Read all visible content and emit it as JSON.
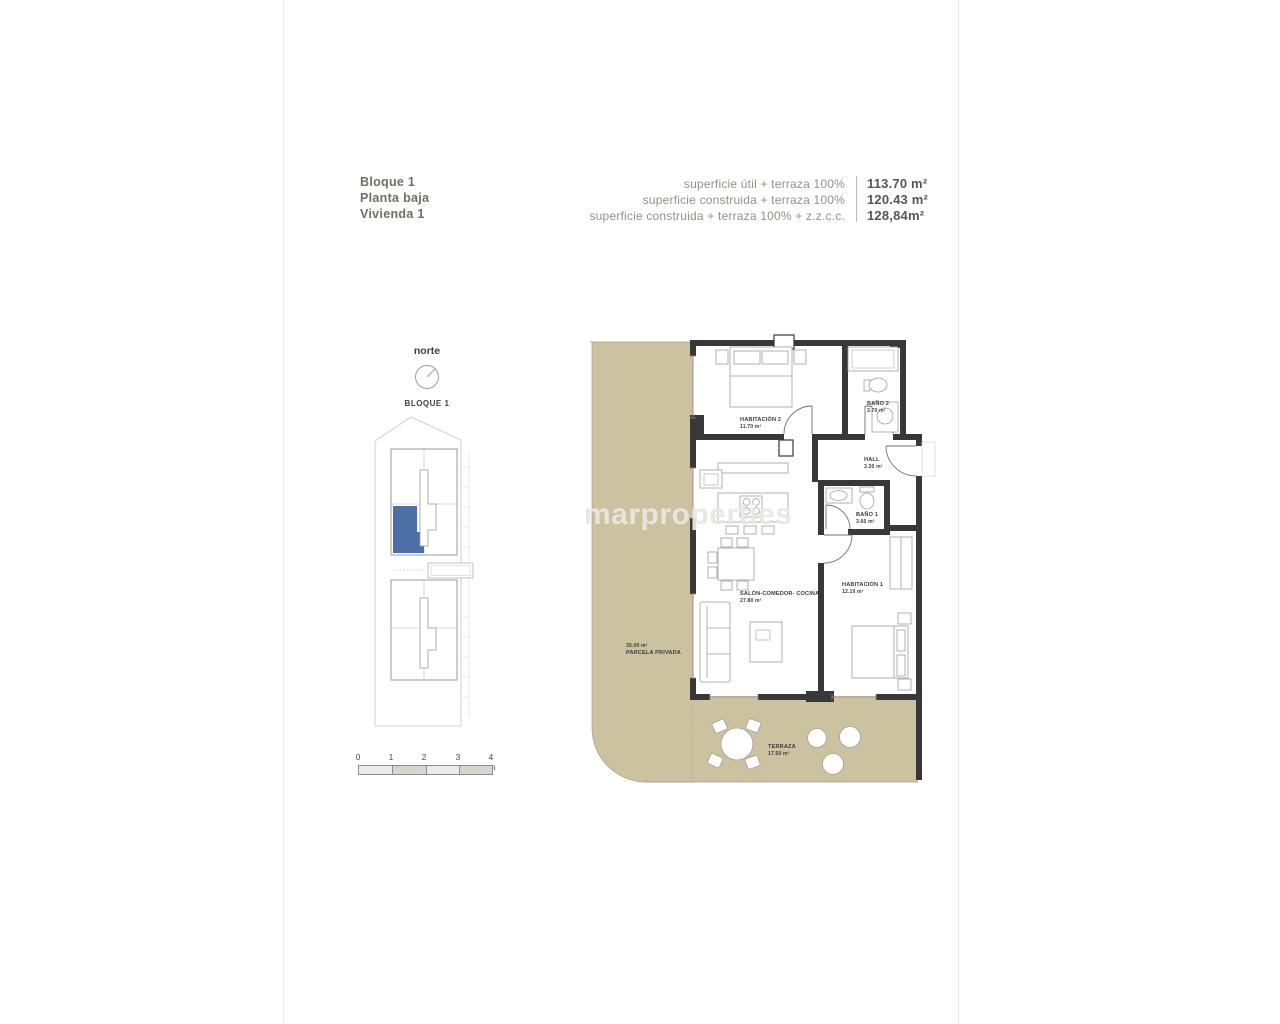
{
  "header": {
    "block": "Bloque 1",
    "floor": "Planta baja",
    "unit": "Vivienda 1",
    "areas": [
      {
        "label": "superficie útil + terraza 100%",
        "value": "113.70 m²"
      },
      {
        "label": "superficie construida + terraza 100%",
        "value": "120.43 m²"
      },
      {
        "label": "superficie construida + terraza 100% + z.z.c.c.",
        "value": "128,84m²"
      }
    ]
  },
  "compass": {
    "label": "norte"
  },
  "site_plan": {
    "title": "BLOQUE 1"
  },
  "scale_bar": {
    "labels": [
      "0",
      "1",
      "2",
      "3",
      "4 m"
    ]
  },
  "floor_plan": {
    "rooms": [
      {
        "name": "HABITACIÓN 2",
        "area": "11.70 m²"
      },
      {
        "name": "BAÑO 2",
        "area": "3.70 m²"
      },
      {
        "name": "HALL",
        "area": "3.30 m²"
      },
      {
        "name": "BAÑO 1",
        "area": "3.60 m²"
      },
      {
        "name": "SALÓN-COMEDOR- COCINA",
        "area": "27.80 m²"
      },
      {
        "name": "HABITACIÓN 1",
        "area": "12.10 m²"
      },
      {
        "name": "TERRAZA",
        "area": "17.50 m²"
      },
      {
        "name": "PARCELA PRIVADA",
        "area": "35.00 m²"
      }
    ]
  },
  "watermark": {
    "text": "marproperties"
  },
  "colors": {
    "outdoor_tan": "#ccc2a0",
    "wall_dark": "#383838",
    "unit_highlight": "#4e6fa5",
    "header_text": "#6f6f5c"
  }
}
